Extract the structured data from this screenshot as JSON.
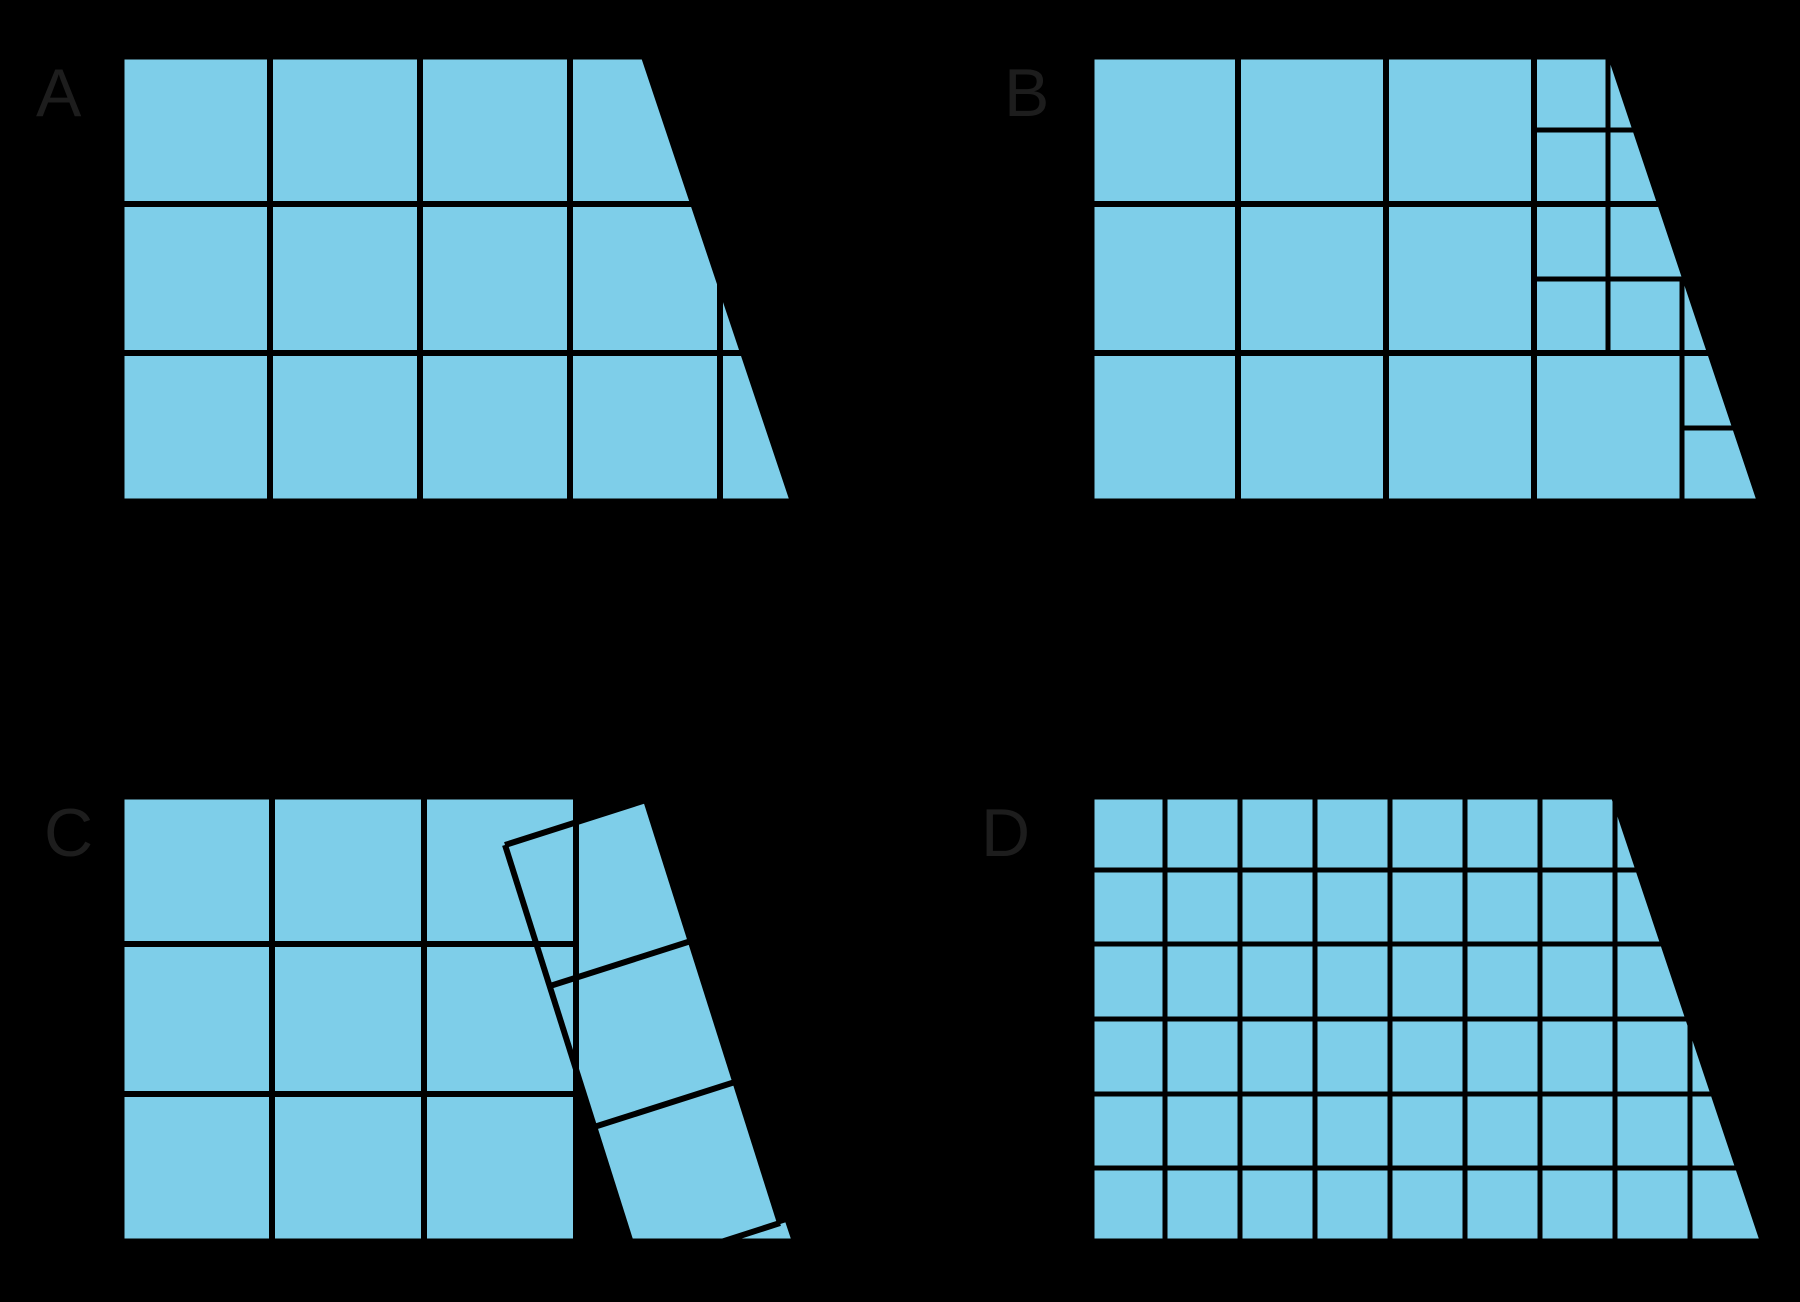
{
  "figure": {
    "canvas": {
      "width": 1800,
      "height": 1302
    },
    "background": "#000000",
    "tile_color": "#7ECEE9",
    "line_color": "#000000",
    "label_color": "#1d1d1d",
    "label_font_size": 68,
    "outline_width": 9,
    "description": "Four copies of the same trapezoid, each tiled with blue squares in a different way",
    "panels": [
      {
        "id": "a",
        "label": "A",
        "label_x": 36,
        "label_y": 116,
        "tiling": "large-squares-grid",
        "shape": [
          [
            120,
            55
          ],
          [
            645,
            55
          ],
          [
            795,
            503
          ],
          [
            120,
            503
          ]
        ],
        "fill_shape": true,
        "clip_lines": true,
        "fills": [],
        "lines": [
          [
            270,
            55,
            270,
            503,
            6
          ],
          [
            420,
            55,
            420,
            503,
            6
          ],
          [
            570,
            55,
            570,
            503,
            6
          ],
          [
            720,
            55,
            720,
            503,
            6
          ],
          [
            120,
            204,
            795,
            204,
            6
          ],
          [
            120,
            353,
            795,
            353,
            6
          ]
        ]
      },
      {
        "id": "b",
        "label": "B",
        "label_x": 1004,
        "label_y": 116,
        "tiling": "large-squares-with-half-and-quarter-squares-near-slant",
        "shape": [
          [
            1090,
            55
          ],
          [
            1612,
            55
          ],
          [
            1762,
            503
          ],
          [
            1090,
            503
          ]
        ],
        "fill_shape": true,
        "clip_lines": true,
        "fills": [],
        "lines": [
          [
            1238,
            55,
            1238,
            503,
            6
          ],
          [
            1386,
            55,
            1386,
            503,
            6
          ],
          [
            1534,
            55,
            1534,
            503,
            6
          ],
          [
            1090,
            204,
            1762,
            204,
            6
          ],
          [
            1090,
            353,
            1762,
            353,
            6
          ],
          [
            1608,
            55,
            1608,
            353,
            5
          ],
          [
            1534,
            130,
            1660,
            130,
            5
          ],
          [
            1534,
            279,
            1700,
            279,
            5
          ],
          [
            1682,
            279,
            1682,
            503,
            5
          ],
          [
            1682,
            428,
            1750,
            428,
            5
          ]
        ]
      },
      {
        "id": "c",
        "label": "C",
        "label_x": 44,
        "label_y": 856,
        "tiling": "grid-of-squares-plus-tilted-column-with-gaps",
        "shape": [
          [
            120,
            795
          ],
          [
            648,
            795
          ],
          [
            797,
            1243
          ],
          [
            120,
            1243
          ]
        ],
        "fill_shape": false,
        "clip_lines": false,
        "fills": [
          [
            [
              120,
              795
            ],
            [
              576,
              795
            ],
            [
              576,
              1243
            ],
            [
              120,
              1243
            ]
          ],
          [
            [
              722,
              1241
            ],
            [
              795,
              1241
            ],
            [
              788,
              1220
            ]
          ],
          [
            [
              505,
              845
            ],
            [
              646,
              800
            ],
            [
              780,
              1223
            ],
            [
              718,
              1243
            ],
            [
              631,
              1243
            ]
          ]
        ],
        "lines": [
          [
            272,
            795,
            272,
            1243,
            6
          ],
          [
            424,
            795,
            424,
            1243,
            6
          ],
          [
            576,
            795,
            576,
            1243,
            6
          ],
          [
            120,
            944,
            576,
            944,
            6
          ],
          [
            120,
            1094,
            576,
            1094,
            6
          ],
          [
            505,
            845,
            646,
            800,
            6
          ],
          [
            505,
            845,
            631,
            1243,
            6
          ],
          [
            646,
            800,
            780,
            1223,
            6
          ],
          [
            780,
            1223,
            718,
            1243,
            6
          ],
          [
            550,
            986,
            691,
            941,
            6
          ],
          [
            594,
            1127,
            735,
            1082,
            6
          ],
          [
            722,
            1241,
            788,
            1220,
            3
          ]
        ]
      },
      {
        "id": "d",
        "label": "D",
        "label_x": 981,
        "label_y": 856,
        "tiling": "small-squares-grid",
        "shape": [
          [
            1090,
            795
          ],
          [
            1615,
            795
          ],
          [
            1765,
            1243
          ],
          [
            1090,
            1243
          ]
        ],
        "fill_shape": true,
        "clip_lines": true,
        "fills": [],
        "lines": [
          [
            1165,
            795,
            1165,
            1243,
            5
          ],
          [
            1240,
            795,
            1240,
            1243,
            5
          ],
          [
            1315,
            795,
            1315,
            1243,
            5
          ],
          [
            1390,
            795,
            1390,
            1243,
            5
          ],
          [
            1465,
            795,
            1465,
            1243,
            5
          ],
          [
            1540,
            795,
            1540,
            1243,
            5
          ],
          [
            1615,
            795,
            1615,
            1243,
            5
          ],
          [
            1690,
            795,
            1690,
            1243,
            5
          ],
          [
            1090,
            870,
            1765,
            870,
            5
          ],
          [
            1090,
            944,
            1765,
            944,
            5
          ],
          [
            1090,
            1019,
            1765,
            1019,
            5
          ],
          [
            1090,
            1094,
            1765,
            1094,
            5
          ],
          [
            1090,
            1168,
            1765,
            1168,
            5
          ]
        ]
      }
    ]
  }
}
